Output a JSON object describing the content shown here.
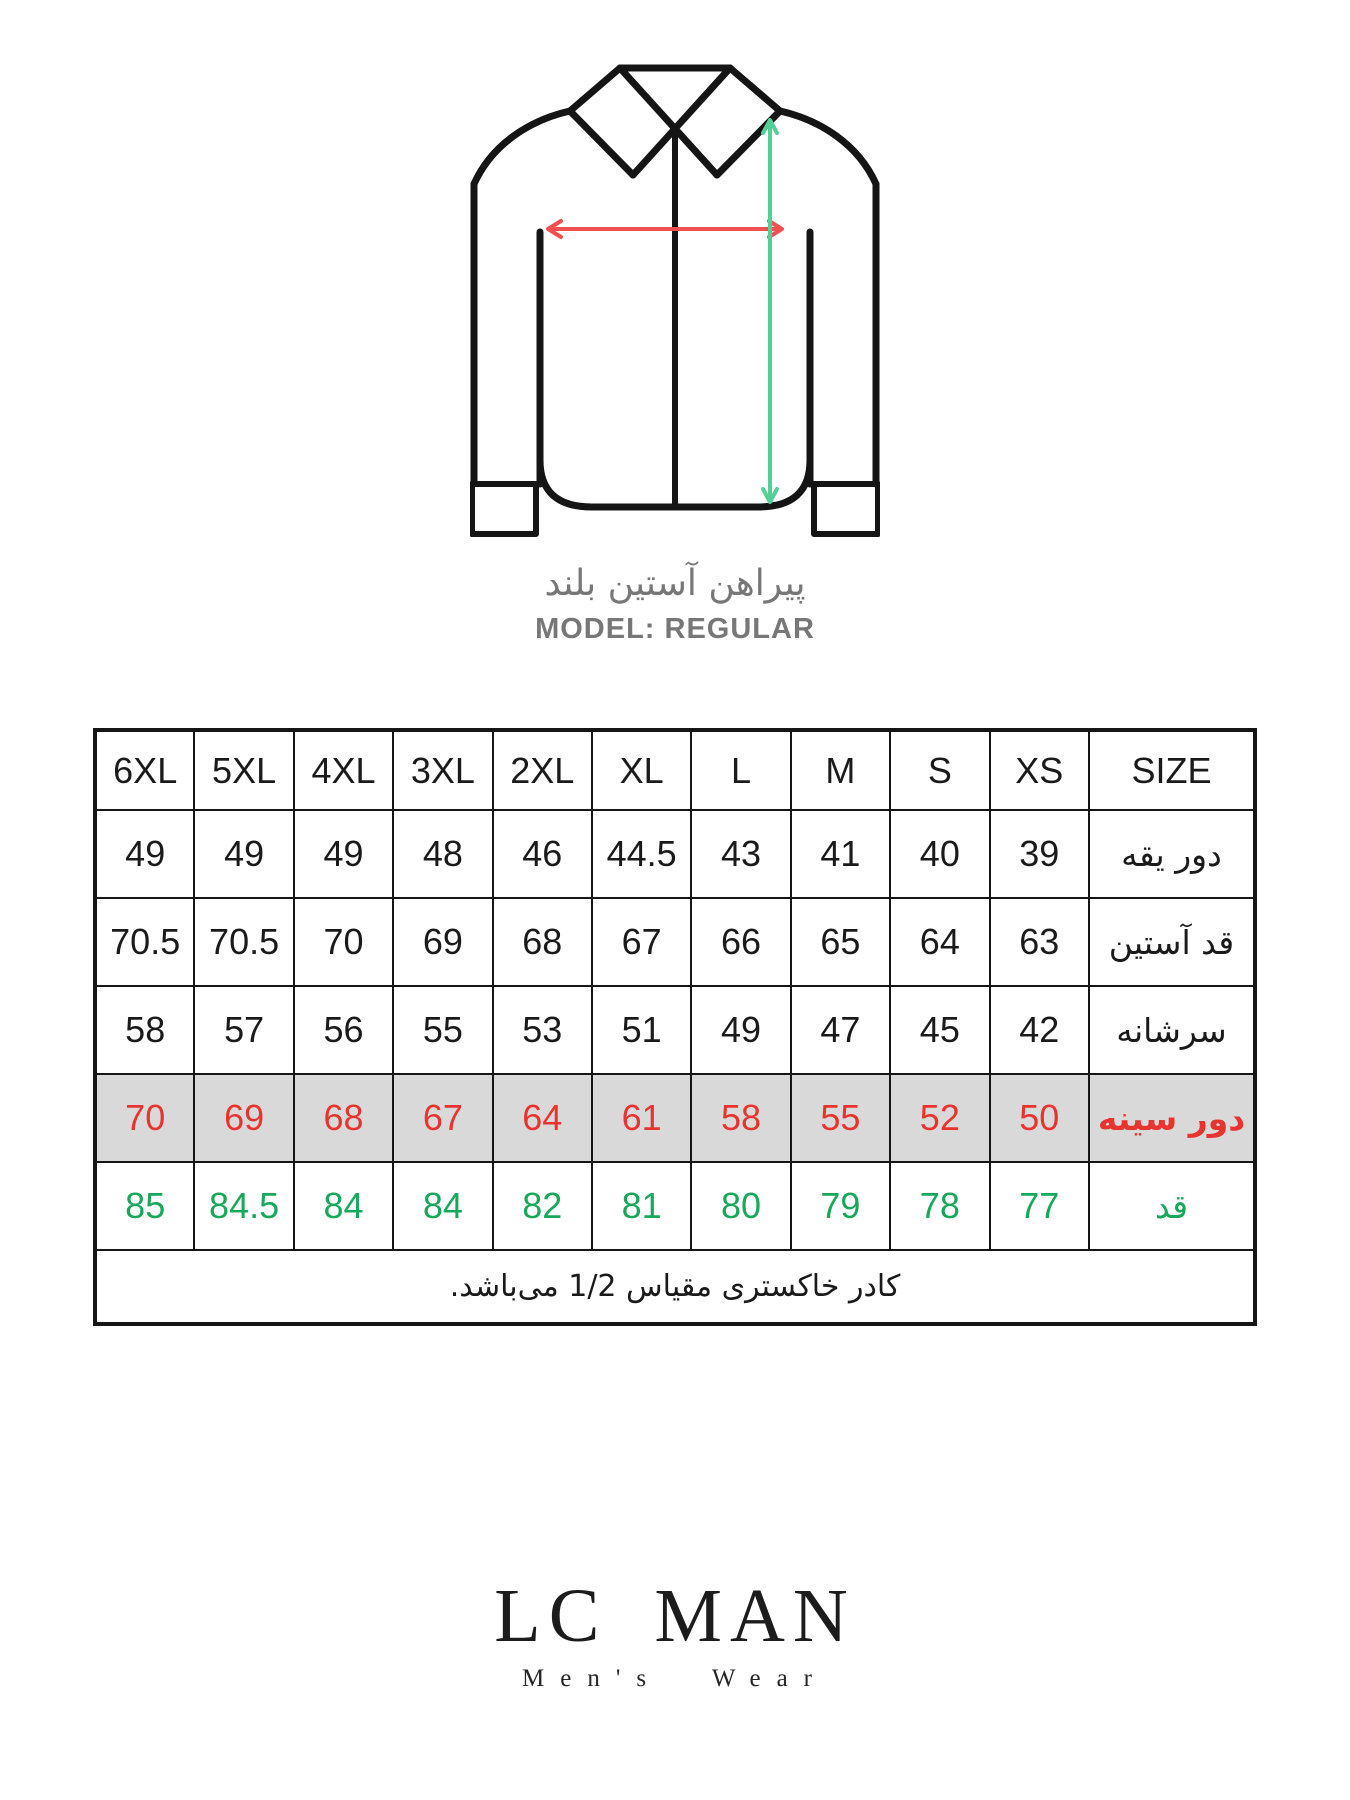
{
  "diagram": {
    "caption_fa": "پیراهن آستین بلند",
    "model_label": "MODEL: REGULAR",
    "outline_color": "#151515",
    "arrow_red": "#f0504f",
    "arrow_green": "#55d095"
  },
  "table": {
    "columns": [
      "6XL",
      "5XL",
      "4XL",
      "3XL",
      "2XL",
      "XL",
      "L",
      "M",
      "S",
      "XS",
      "SIZE"
    ],
    "rows": [
      {
        "label": "دور یقه",
        "style": "default",
        "values": [
          "49",
          "49",
          "49",
          "48",
          "46",
          "44.5",
          "43",
          "41",
          "40",
          "39"
        ]
      },
      {
        "label": "قد آستین",
        "style": "default",
        "values": [
          "70.5",
          "70.5",
          "70",
          "69",
          "68",
          "67",
          "66",
          "65",
          "64",
          "63"
        ]
      },
      {
        "label": "سرشانه",
        "style": "default",
        "values": [
          "58",
          "57",
          "56",
          "55",
          "53",
          "51",
          "49",
          "47",
          "45",
          "42"
        ]
      },
      {
        "label": "دور سینه",
        "style": "highlight",
        "values": [
          "70",
          "69",
          "68",
          "67",
          "64",
          "61",
          "58",
          "55",
          "52",
          "50"
        ]
      },
      {
        "label": "قد",
        "style": "green",
        "values": [
          "85",
          "84.5",
          "84",
          "84",
          "82",
          "81",
          "80",
          "79",
          "78",
          "77"
        ]
      }
    ],
    "note": "کادر خاکستری مقیاس 1/2 می‌باشد.",
    "colors": {
      "text": "#1a1a1a",
      "border": "#161616",
      "highlight_bg": "#d9d9d9",
      "red": "#e8332e",
      "green": "#17a85a"
    }
  },
  "footer": {
    "brand": "LC MAN",
    "tagline": "Men's Wear"
  },
  "chart_data": {
    "type": "table",
    "title": "MODEL: REGULAR — پیراهن آستین بلند",
    "columns": [
      "6XL",
      "5XL",
      "4XL",
      "3XL",
      "2XL",
      "XL",
      "L",
      "M",
      "S",
      "XS"
    ],
    "series": [
      {
        "name": "دور یقه",
        "values": [
          49,
          49,
          49,
          48,
          46,
          44.5,
          43,
          41,
          40,
          39
        ]
      },
      {
        "name": "قد آستین",
        "values": [
          70.5,
          70.5,
          70,
          69,
          68,
          67,
          66,
          65,
          64,
          63
        ]
      },
      {
        "name": "سرشانه",
        "values": [
          58,
          57,
          56,
          55,
          53,
          51,
          49,
          47,
          45,
          42
        ]
      },
      {
        "name": "دور سینه",
        "values": [
          70,
          69,
          68,
          67,
          64,
          61,
          58,
          55,
          52,
          50
        ]
      },
      {
        "name": "قد",
        "values": [
          85,
          84.5,
          84,
          84,
          82,
          81,
          80,
          79,
          78,
          77
        ]
      }
    ],
    "note": "کادر خاکستری مقیاس 1/2 می‌باشد."
  }
}
